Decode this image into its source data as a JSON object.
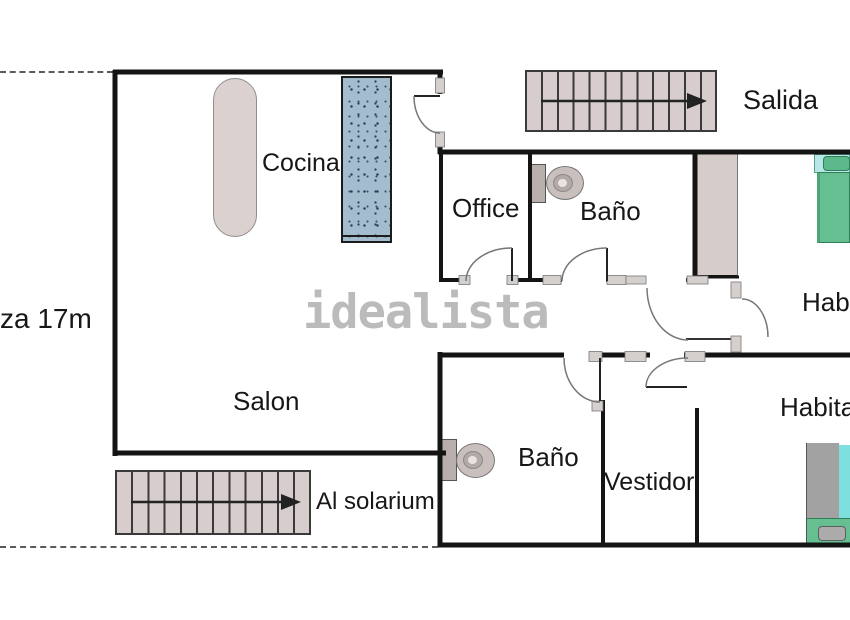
{
  "watermark": "idealista",
  "labels": {
    "terrace": "za 17m"
  },
  "rooms": {
    "cocina": "Cocina",
    "office": "Office",
    "bano_top": "Baño",
    "salon": "Salon",
    "bano_bottom": "Baño",
    "vestidor": "Vestidor",
    "habitacion_top": "Habitación",
    "habitacion_bottom": "Habitación"
  },
  "stairs": {
    "top": {
      "label": "Salida",
      "treads": 12,
      "direction": "right"
    },
    "bottom": {
      "label": "Al solarium",
      "treads": 12,
      "direction": "right"
    }
  },
  "colors": {
    "wall": "#141414",
    "stair_fill": "#d7cdcc",
    "island_fill": "#dbd1ce",
    "counter_fill": "#a4bdce",
    "closet_fill": "#d6cdca",
    "bed_green": "#66bf91",
    "bed_cyan": "#7de0de",
    "bed_gray": "#a2a2a2",
    "watermark_gray": "#bbbbbb"
  }
}
